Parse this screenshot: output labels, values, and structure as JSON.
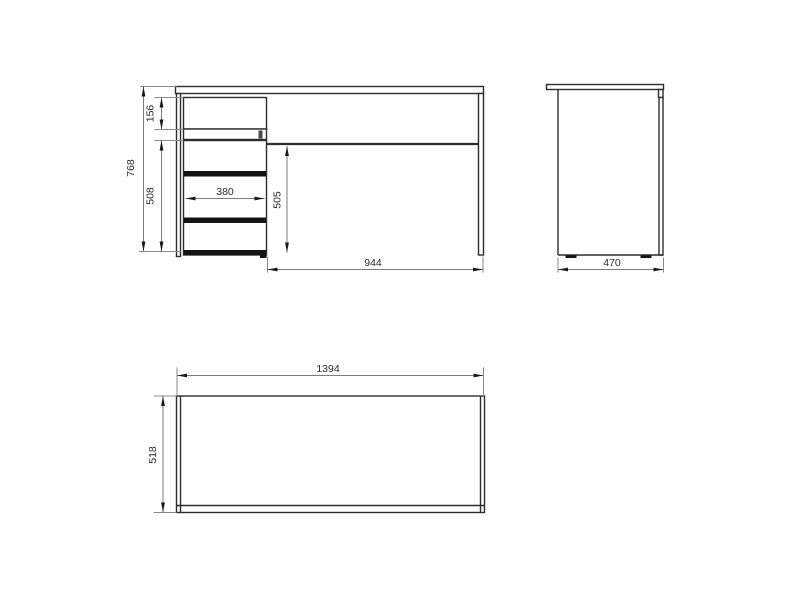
{
  "drawing_type": "furniture-dimension-drawing",
  "colors": {
    "background": "#ffffff",
    "outline": "#2d2d2d",
    "drawer_band_fill": "#141414",
    "dimension_line": "#7d7d7d",
    "arrowhead": "#1a1a1a",
    "label_text": "#2b2b2b"
  },
  "views": {
    "front": {
      "dimensions": {
        "total_height": "768",
        "top_drawer_height": "156",
        "drawer_section_height": "508",
        "drawer_width": "380",
        "knee_space_height": "505",
        "knee_space_width": "944"
      }
    },
    "side": {
      "dimensions": {
        "depth": "470"
      }
    },
    "top": {
      "dimensions": {
        "width": "1394",
        "depth": "518"
      }
    }
  }
}
